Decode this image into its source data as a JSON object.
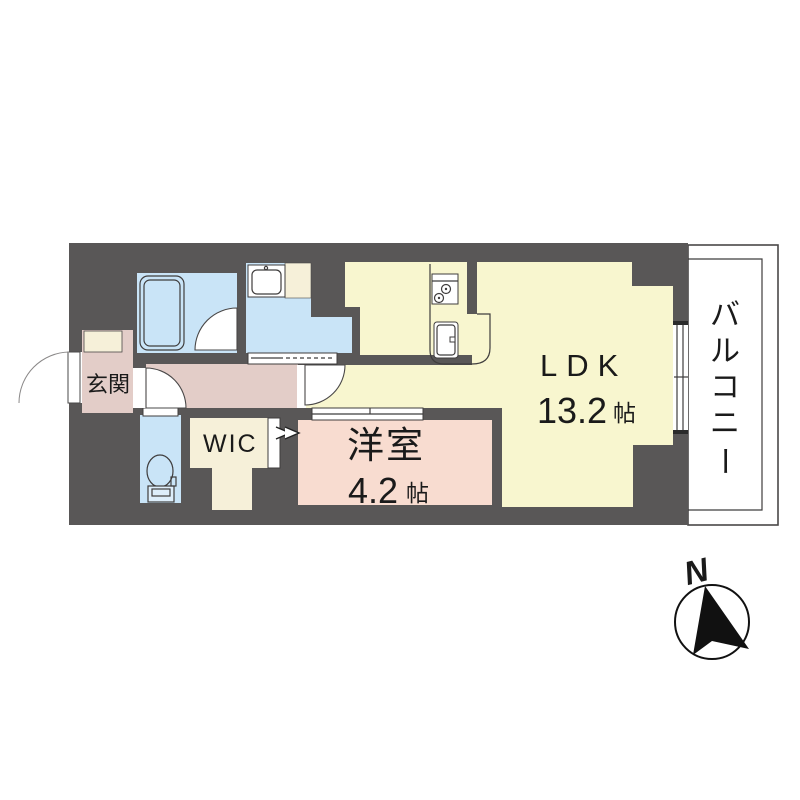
{
  "plan": {
    "rooms": {
      "ldk": {
        "label": "LDK",
        "size_num": "13.2",
        "size_unit": "帖"
      },
      "bedroom": {
        "label": "洋室",
        "size_num": "4.2",
        "size_unit": "帖"
      },
      "wic": {
        "label": "WIC"
      },
      "entrance": {
        "label": "玄関"
      },
      "balcony": {
        "label": "バルコニー",
        "chars": [
          "バ",
          "ル",
          "コ",
          "ニ",
          "ー"
        ]
      }
    },
    "compass": {
      "label": "N"
    },
    "fixtures": [
      "bathtub-icon",
      "vanity-sink-icon",
      "toilet-icon",
      "stove-icon",
      "kitchen-sink-icon"
    ],
    "colors": {
      "wall": "#595757",
      "ldk_floor": "#f8f6cf",
      "bedroom_floor": "#f8dcd0",
      "hall_floor": "#e3cdc8",
      "wet_area_floor": "#c9e4f7",
      "closet_floor": "#f6f0d9",
      "balcony": "#ffffff",
      "text": "#1a1a1a"
    }
  }
}
